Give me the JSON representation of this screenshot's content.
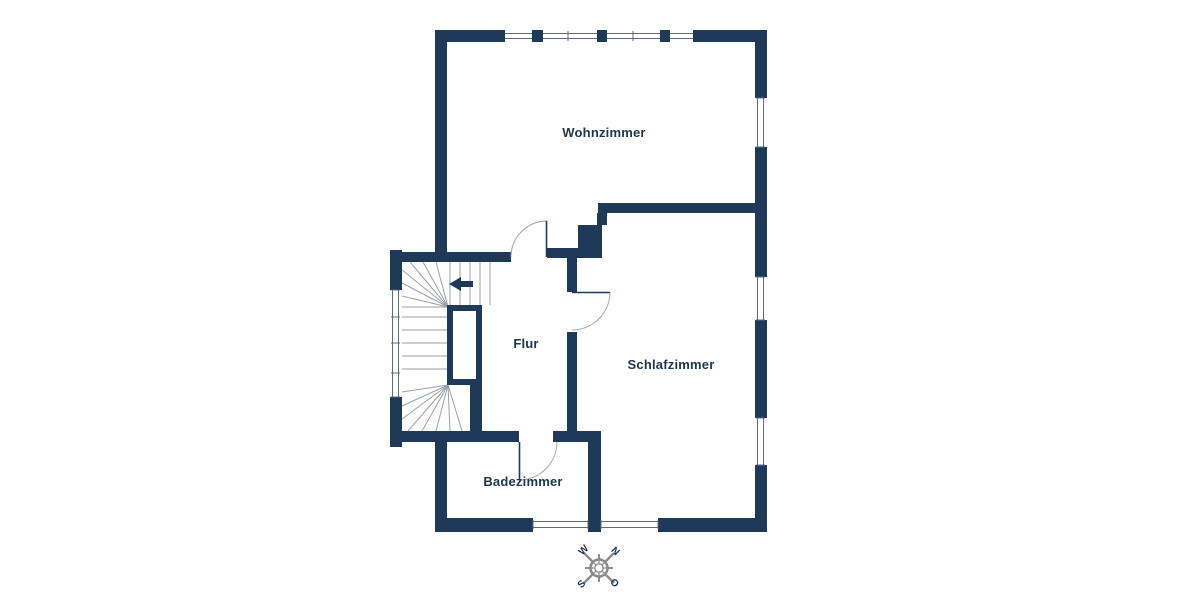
{
  "floorplan": {
    "title": "Obergeschoss Grundriss",
    "rooms": [
      {
        "name": "Wohnzimmer"
      },
      {
        "name": "Schlafzimmer"
      },
      {
        "name": "Flur"
      },
      {
        "name": "Badezimmer"
      }
    ],
    "stairs": {
      "direction_arrow": "left-arrow"
    },
    "compass": {
      "w": "W",
      "n": "N",
      "s": "S",
      "o": "O"
    },
    "colors": {
      "wall": "#1e3a58",
      "line": "#9aa0ab",
      "glazing": "#5c6b82",
      "text": "#1e3550",
      "compass": "#8c8c8c",
      "background": "#ffffff"
    }
  }
}
